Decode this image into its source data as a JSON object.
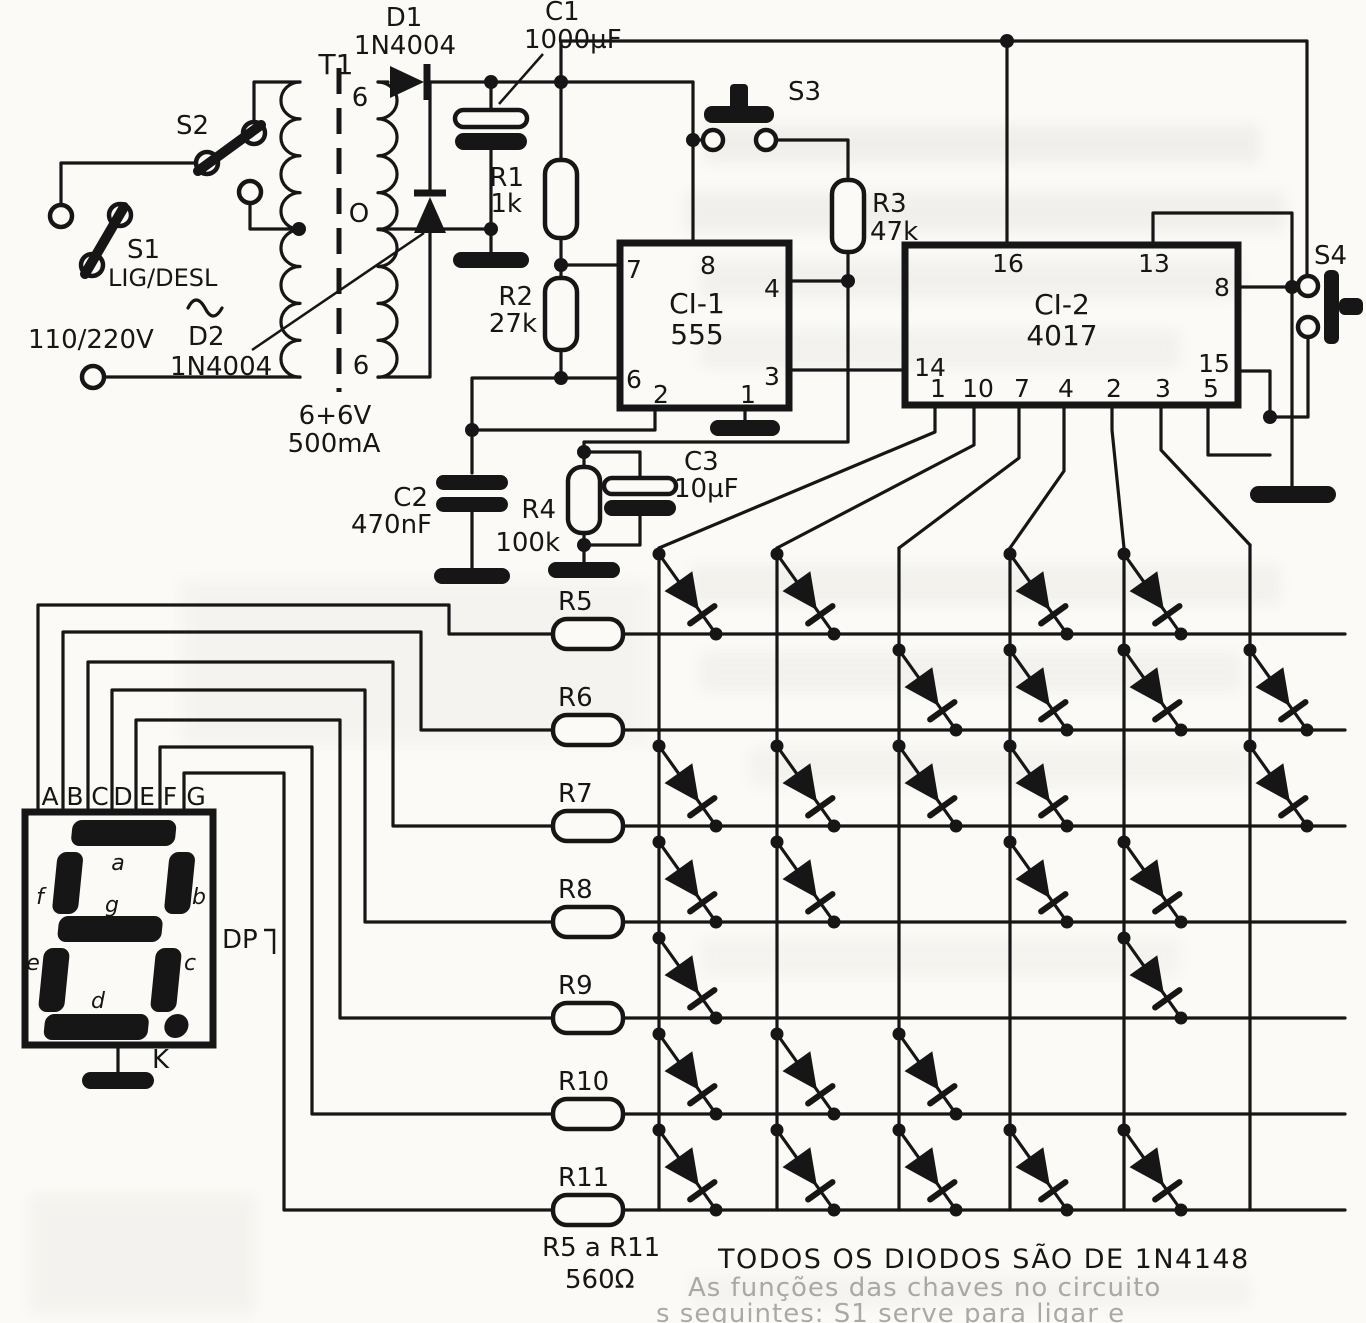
{
  "power": {
    "s2": "S2",
    "s1": "S1",
    "s1_mode": "LIG/DESL",
    "ac_voltage": "110/220V",
    "transformer": "T1",
    "tap_top": "6",
    "tap_mid": "O",
    "tap_bot": "6",
    "rating_v": "6+6V",
    "rating_i": "500mA",
    "d1": "D1",
    "d1_part": "1N4004",
    "d2": "D2",
    "d2_part": "1N4004",
    "c1": "C1",
    "c1_value": "1000µF"
  },
  "oscillator": {
    "r1": "R1",
    "r1_value": "1k",
    "r2": "R2",
    "r2_value": "27k",
    "ic": "CI-1",
    "ic_part": "555",
    "pins": {
      "p7": "7",
      "p8": "8",
      "p4": "4",
      "p3": "3",
      "p6": "6",
      "p2": "2",
      "p1": "1"
    },
    "s3": "S3",
    "r3": "R3",
    "r3_value": "47k",
    "c2": "C2",
    "c2_value": "470nF",
    "r4": "R4",
    "r4_value": "100k",
    "c3": "C3",
    "c3_value": "10µF"
  },
  "counter": {
    "ic": "CI-2",
    "ic_part": "4017",
    "pin16": "16",
    "pin13": "13",
    "pin8": "8",
    "pin14": "14",
    "pin15": "15",
    "bottom_pins": [
      "1",
      "10",
      "7",
      "4",
      "2",
      "3",
      "5"
    ],
    "s4": "S4"
  },
  "display": {
    "segment_pins": [
      "A",
      "B",
      "C",
      "D",
      "E",
      "F",
      "G"
    ],
    "seg_a": "a",
    "seg_b": "b",
    "seg_c": "c",
    "seg_d": "d",
    "seg_e": "e",
    "seg_f": "f",
    "seg_g": "g",
    "dp": "DP",
    "cathode": "K"
  },
  "matrix": {
    "row_resistors": [
      "R5",
      "R6",
      "R7",
      "R8",
      "R9",
      "R10",
      "R11"
    ],
    "rows_active_cols": [
      [
        1,
        2,
        4,
        5
      ],
      [
        3,
        4,
        5,
        6
      ],
      [
        1,
        2,
        3,
        4,
        6
      ],
      [
        1,
        2,
        4,
        5
      ],
      [
        1,
        5
      ],
      [
        1,
        2,
        3
      ],
      [
        1,
        2,
        3,
        4,
        5
      ]
    ],
    "resistor_range_note": "R5 a R11",
    "resistor_value": "560Ω",
    "diode_note": "TODOS OS DIODOS SÃO DE 1N4148"
  },
  "bleedthrough": {
    "line1": "As funções das chaves no circuito",
    "line2": "s seguintes: S1 serve para ligar e"
  }
}
